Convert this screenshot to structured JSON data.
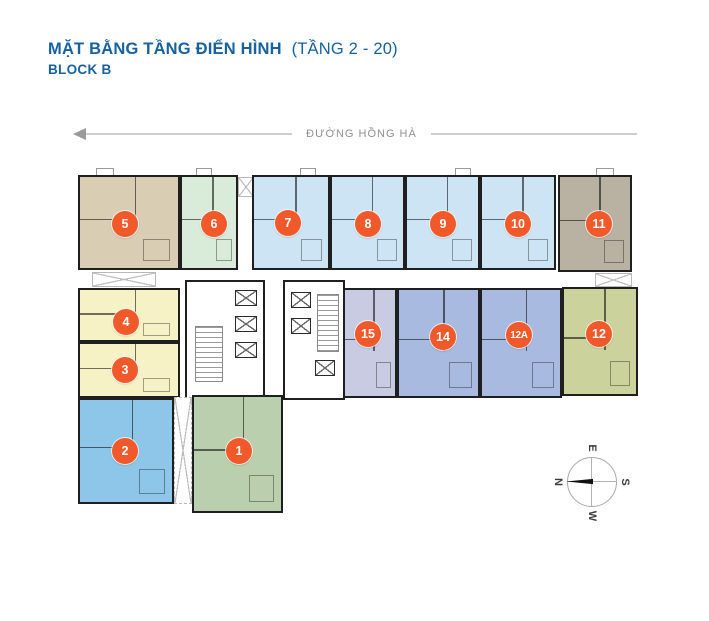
{
  "header": {
    "title_main": "MẶT BẰNG TẦNG ĐIỂN HÌNH",
    "title_paren": "(TẦNG 2 - 20)",
    "subtitle": "BLOCK B",
    "title_color": "#17619f"
  },
  "street": {
    "label": "ĐƯỜNG HỒNG HÀ",
    "arrow_direction": "left"
  },
  "compass": {
    "n": "N",
    "e": "E",
    "s": "S",
    "w": "W"
  },
  "colors": {
    "wall": "#1f1f1f",
    "badge_orange": "#f1592a",
    "street_line": "#cfcfcf",
    "street_text": "#8f8f8f"
  },
  "units": [
    {
      "label": "1",
      "color": "#b9cfad"
    },
    {
      "label": "2",
      "color": "#8ec6e9"
    },
    {
      "label": "3",
      "color": "#f7f1c6"
    },
    {
      "label": "4",
      "color": "#f7f1c6"
    },
    {
      "label": "5",
      "color": "#d9cdb4"
    },
    {
      "label": "6",
      "color": "#d8ecd9"
    },
    {
      "label": "7",
      "color": "#cde4f4"
    },
    {
      "label": "8",
      "color": "#cde4f4"
    },
    {
      "label": "9",
      "color": "#cde4f4"
    },
    {
      "label": "10",
      "color": "#cde4f4"
    },
    {
      "label": "11",
      "color": "#b9b2a2"
    },
    {
      "label": "12",
      "color": "#ccd29c"
    },
    {
      "label": "12A",
      "color": "#a8badf"
    },
    {
      "label": "14",
      "color": "#a8badf"
    },
    {
      "label": "15",
      "color": "#c9cbe3"
    }
  ]
}
